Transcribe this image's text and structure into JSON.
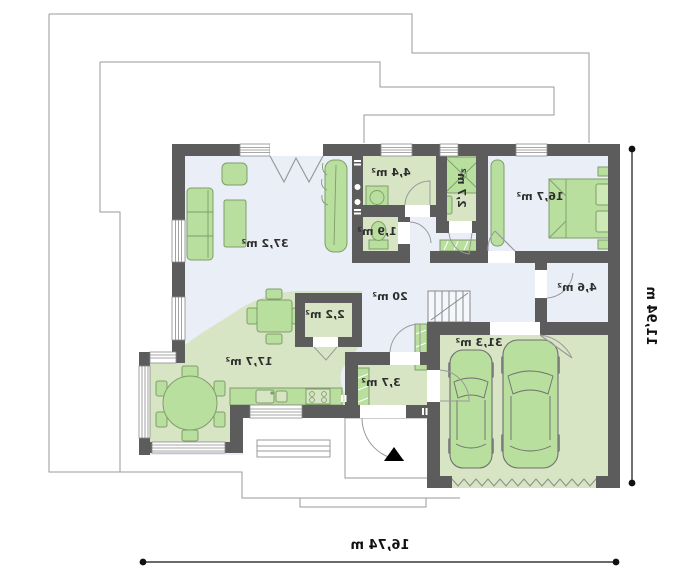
{
  "floor_plan": {
    "type": "house ground floor plan (mirrored rendering)",
    "rooms": {
      "living_room": {
        "area": "37,2 m²"
      },
      "kitchen_dining": {
        "area": "17,7 m²"
      },
      "hall": {
        "area": "20 m²"
      },
      "pantry": {
        "area": "2,2 m²"
      },
      "laundry": {
        "area": "4,4 m²"
      },
      "bathroom": {
        "area": "2,7 m²"
      },
      "wc": {
        "area": "1,9 m²"
      },
      "bedroom": {
        "area": "16,7 m²"
      },
      "storage": {
        "area": "4,6 m²"
      },
      "vestibule": {
        "area": "3,7 m²"
      },
      "garage": {
        "area": "31,3 m²"
      }
    },
    "dimensions": {
      "overall_width": "16,74 m",
      "overall_depth": "11,94 m"
    },
    "icons": {
      "entrance_arrow": "black triangle marking main entrance",
      "stairs": "staircase to upper floor",
      "cars": "two cars in garage"
    },
    "colors": {
      "wall": "#5c5c5c",
      "floor_blue": "#e9eef7",
      "floor_green": "#d7e5c5",
      "furniture_green": "#b8df9d",
      "outline": "#9a9a9a",
      "text": "#2e2e2e"
    }
  }
}
